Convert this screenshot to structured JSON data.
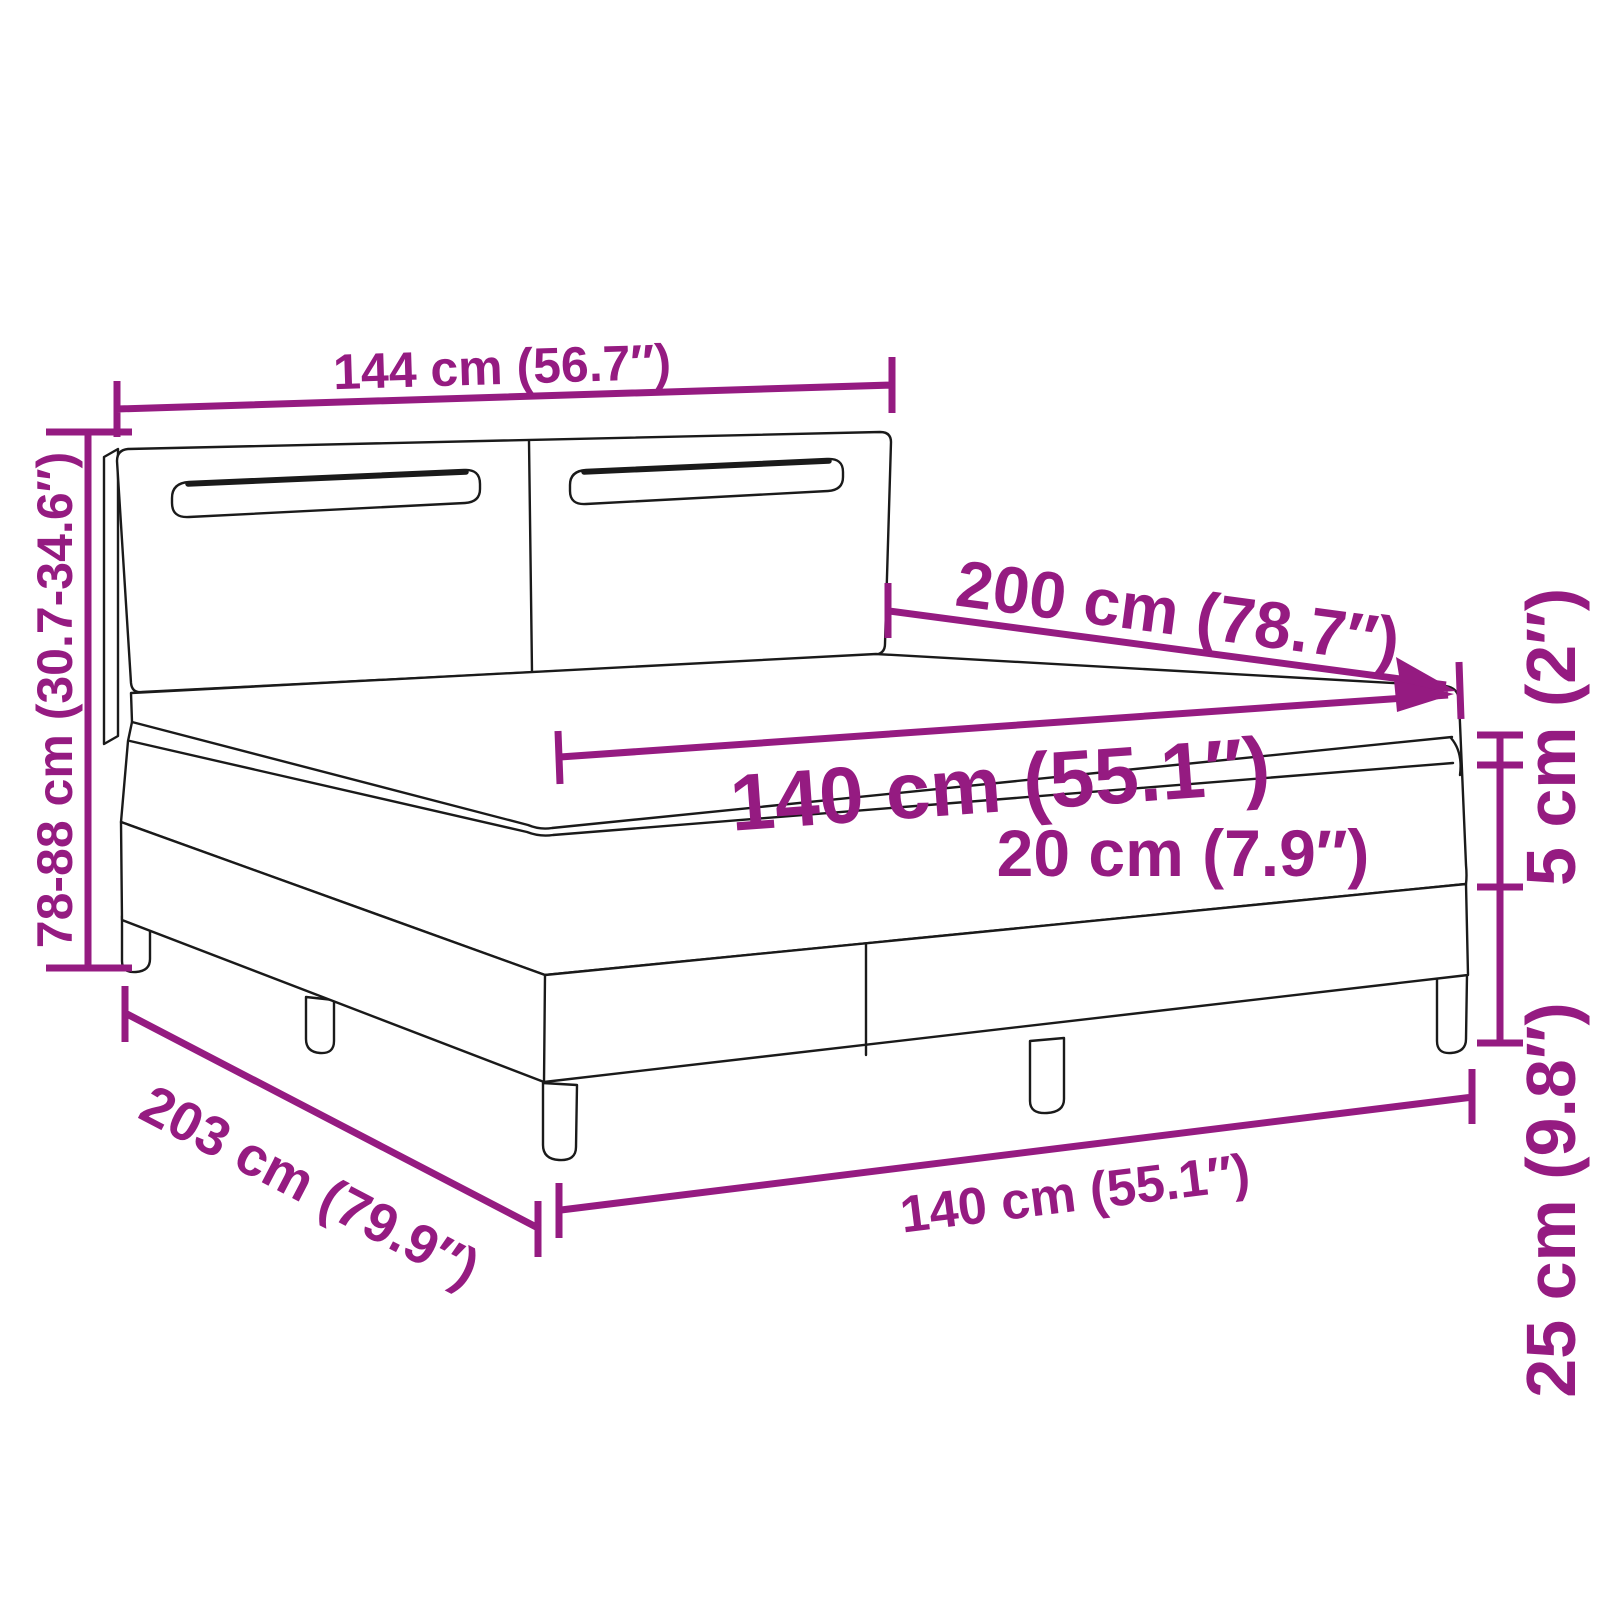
{
  "colors": {
    "accent": "#951B81",
    "line": "#1a1a1a"
  },
  "labels": {
    "headboard_width": "144 cm (56.7″)",
    "headboard_height": "78-88 cm (30.7-34.6″)",
    "bed_length": "200 cm (78.7″)",
    "mattress_width": "140 cm (55.1″)",
    "mattress_height": "20 cm (7.9″)",
    "base_height": "25 cm (9.8″)",
    "topper_height": "5 cm (2″)",
    "total_length": "203 cm (79.9″)",
    "base_width": "140 cm (55.1″)"
  }
}
